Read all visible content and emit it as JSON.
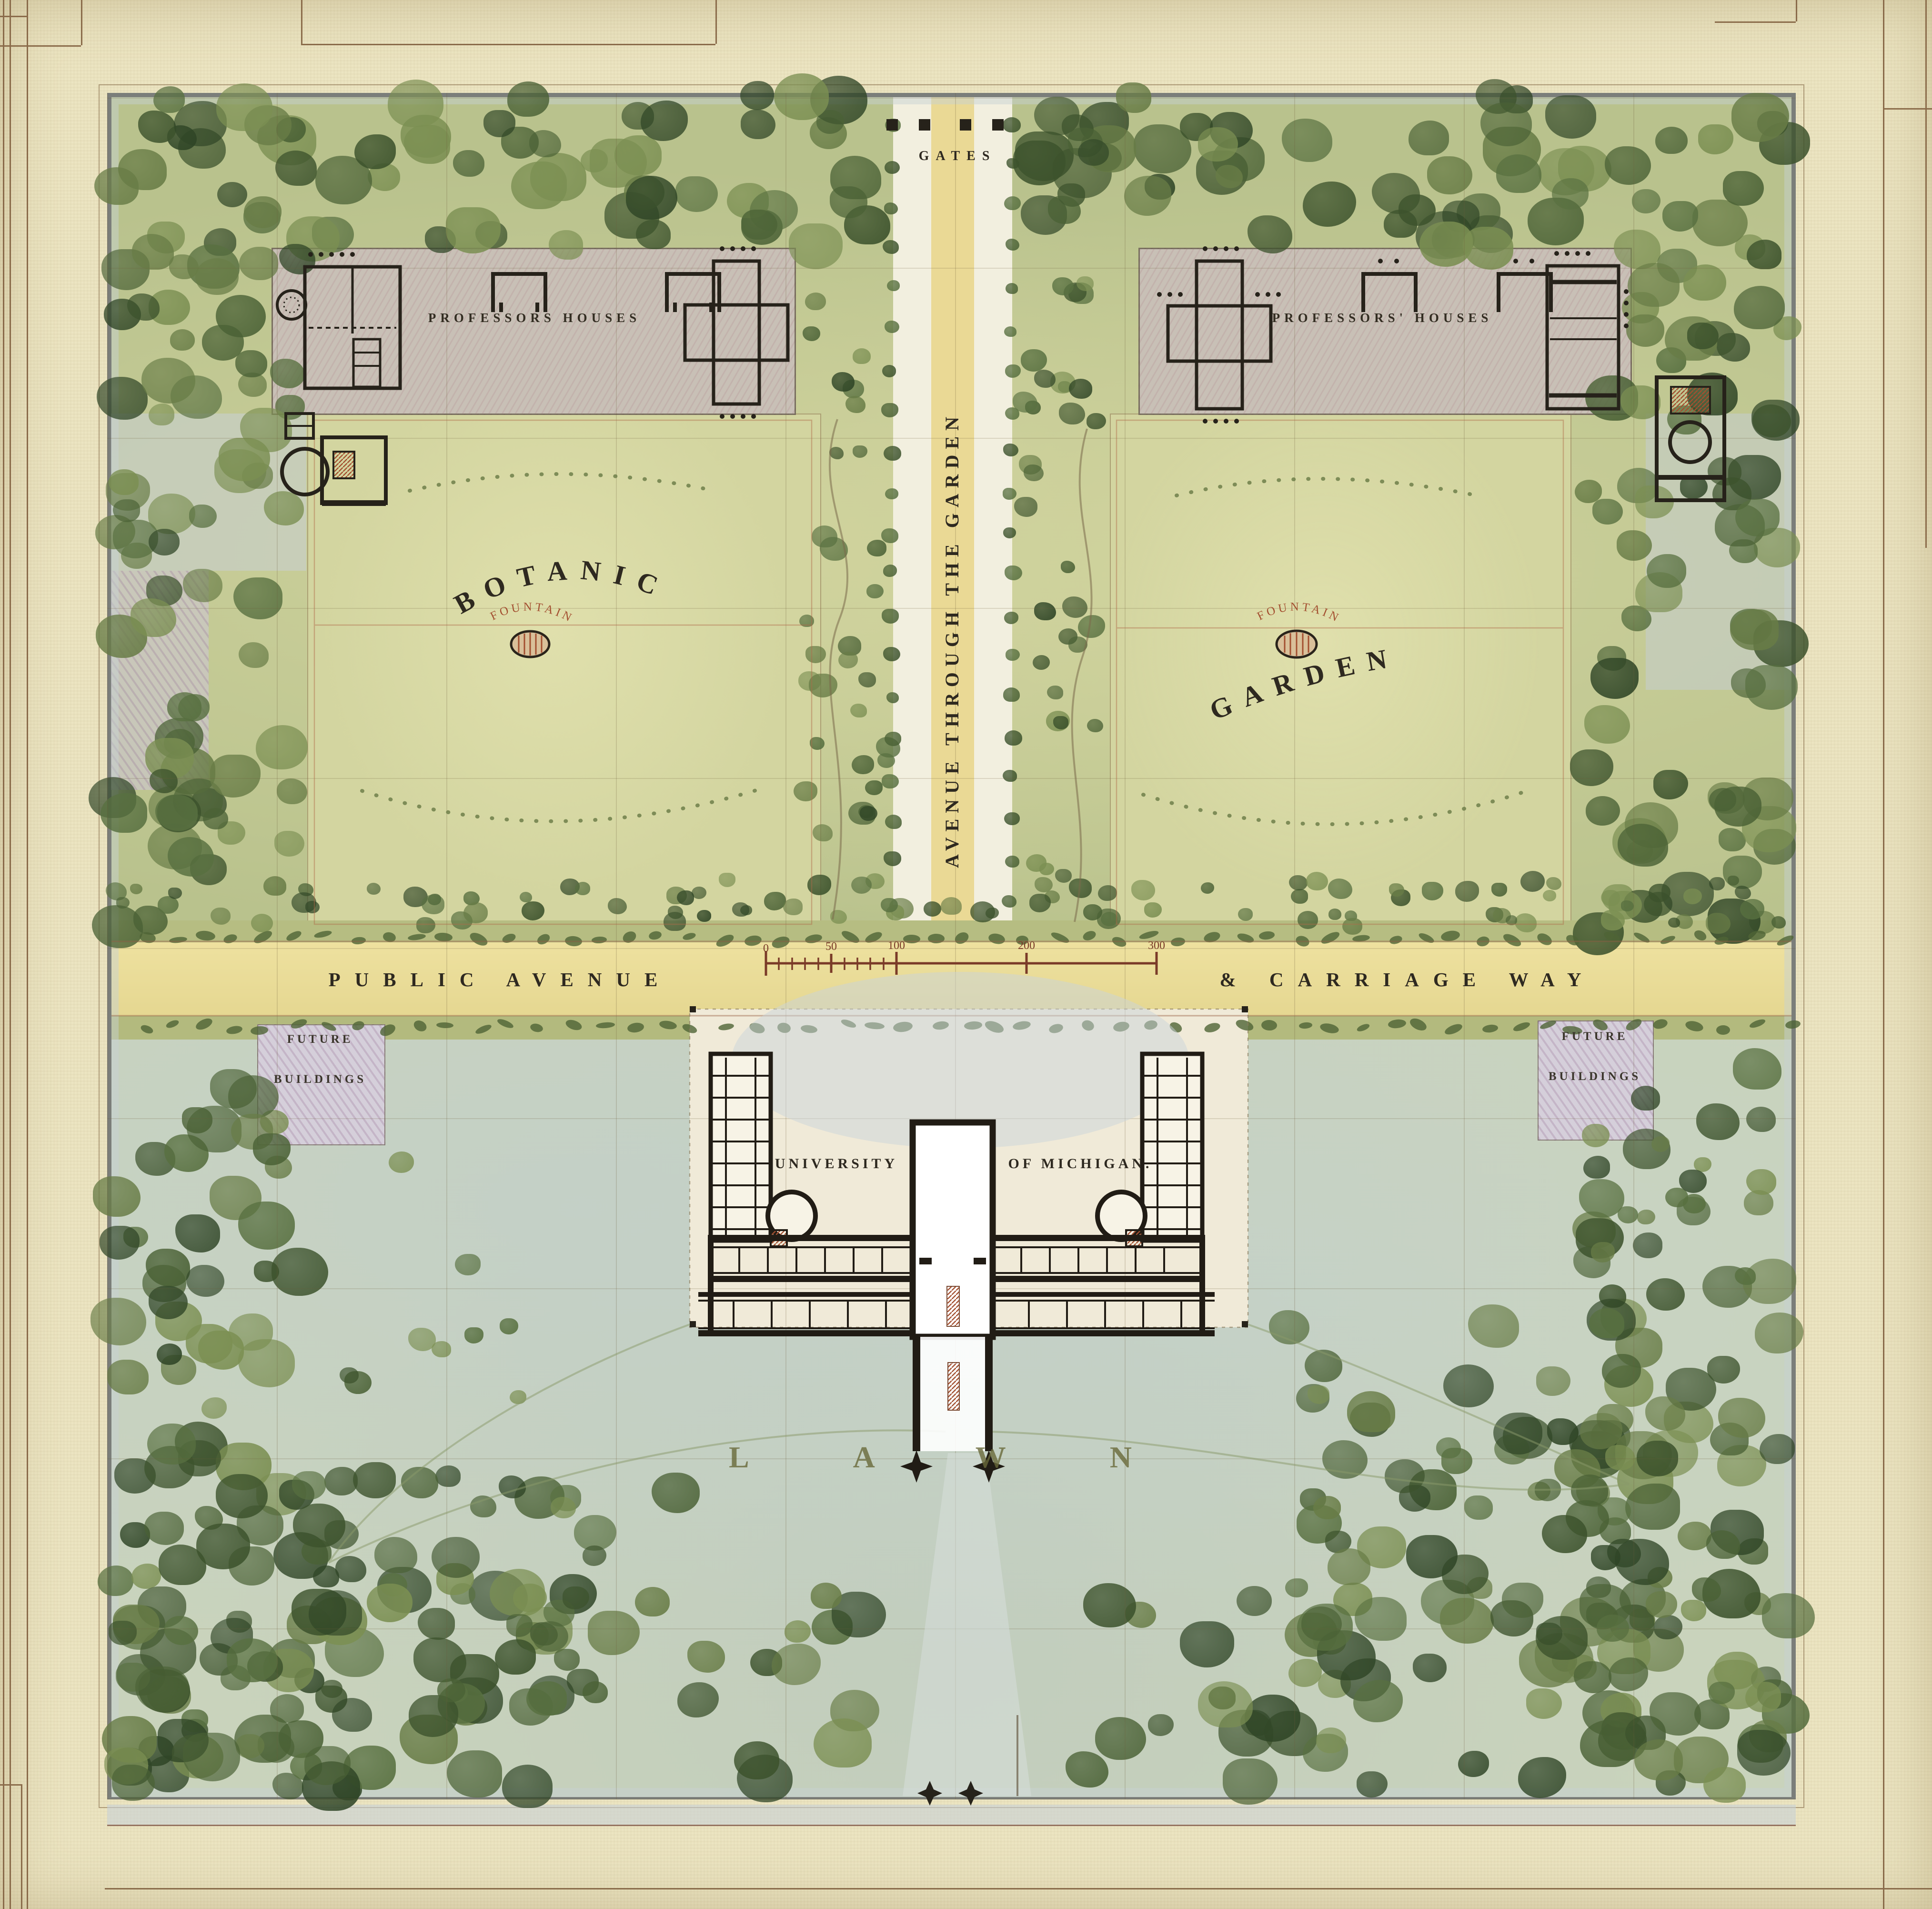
{
  "map": {
    "title": "Plan of university grounds with botanic garden, public avenue and lawn",
    "labels": {
      "gates": "GATES",
      "professors_left": "PROFESSORS HOUSES",
      "professors_right": "PROFESSORS' HOUSES",
      "botanic": "BOTANIC",
      "garden": "GARDEN",
      "fountain": "FOUNTAIN",
      "avenue_vertical": "AVENUE THROUGH THE GARDEN",
      "public_avenue": "PUBLIC AVENUE",
      "carriage_way": "& CARRIAGE WAY",
      "future_line1": "FUTURE",
      "future_line2": "BUILDINGS",
      "university": "UNIVERSITY",
      "of_michigan": "OF MICHIGAN.",
      "lawn": "LAWN"
    },
    "scale_bar": {
      "ticks": [
        "0",
        "50",
        "100",
        "200",
        "300"
      ]
    },
    "colors": {
      "paper": "#ece5c2",
      "ink": "#2a241b",
      "red_ink": "#8d4128",
      "tree_green": "#55693a",
      "garden_panel": "#d4d6a1",
      "lawn_wash": "#c9d3bf",
      "avenue_yellow": "#e9dc9d",
      "sidewalk_blue": "#ccd3d6",
      "future_block_lavender": "#d5cfda"
    }
  }
}
